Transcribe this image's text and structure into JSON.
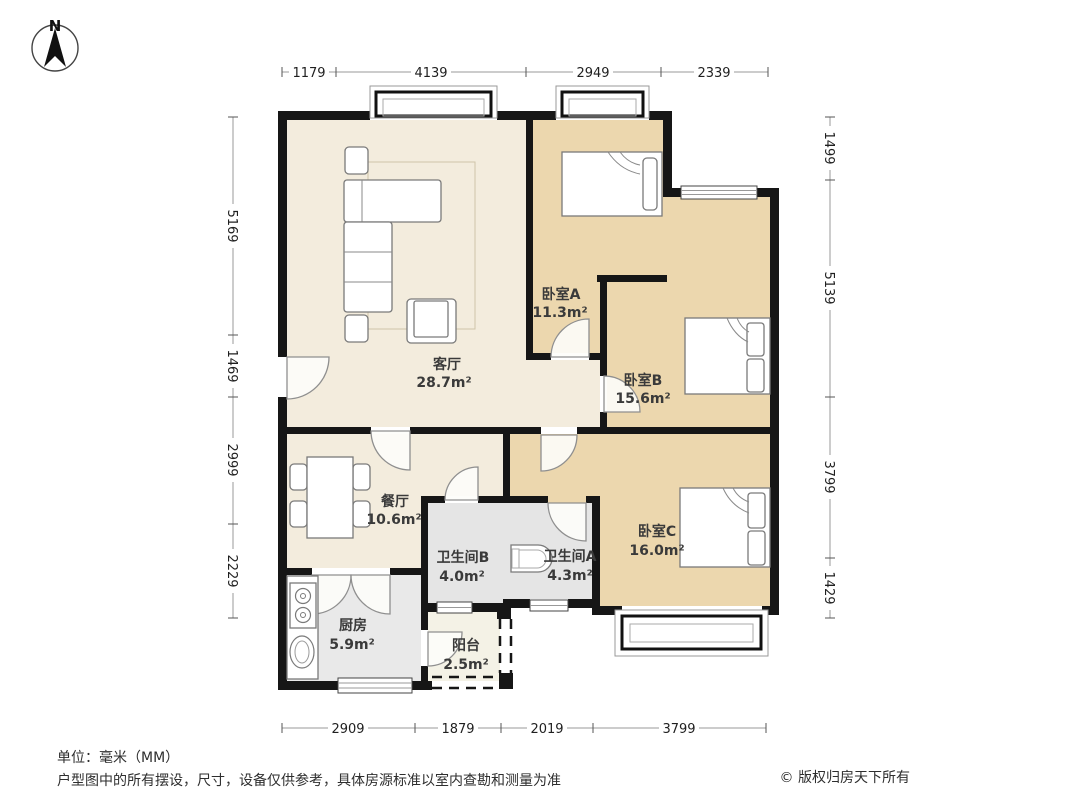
{
  "compass": {
    "label": "N"
  },
  "rooms": [
    {
      "id": "living",
      "name": "客厅",
      "area": "28.7m²"
    },
    {
      "id": "bedroom-a",
      "name": "卧室A",
      "area": "11.3m²"
    },
    {
      "id": "bedroom-b",
      "name": "卧室B",
      "area": "15.6m²"
    },
    {
      "id": "bedroom-c",
      "name": "卧室C",
      "area": "16.0m²"
    },
    {
      "id": "dining",
      "name": "餐厅",
      "area": "10.6m²"
    },
    {
      "id": "bath-b",
      "name": "卫生间B",
      "area": "4.0m²"
    },
    {
      "id": "bath-a",
      "name": "卫生间A",
      "area": "4.3m²"
    },
    {
      "id": "kitchen",
      "name": "厨房",
      "area": "5.9m²"
    },
    {
      "id": "balcony",
      "name": "阳台",
      "area": "2.5m²"
    }
  ],
  "dimensions": {
    "top": [
      "1179",
      "4139",
      "2949",
      "2339"
    ],
    "left": [
      "5169",
      "1469",
      "2999",
      "2229"
    ],
    "right": [
      "1499",
      "5139",
      "3799",
      "1429"
    ],
    "bottom": [
      "2909",
      "1879",
      "2019",
      "3799"
    ]
  },
  "footer": {
    "unit_note": "单位：毫米（MM）",
    "disclaimer": "户型图中的所有摆设，尺寸，设备仅供参考，具体房源标准以室内查勘和测量为准",
    "copyright": "© 版权归房天下所有"
  },
  "colors": {
    "wall": "#161616",
    "bedroom_floor": "#ecd7ae",
    "living_floor": "#f3ecdd",
    "bath_floor": "#e5e5e5",
    "kitchen_floor": "#e9e9e9",
    "balcony_floor": "#f4f2e6",
    "dimension_line": "#9a9a9a"
  }
}
